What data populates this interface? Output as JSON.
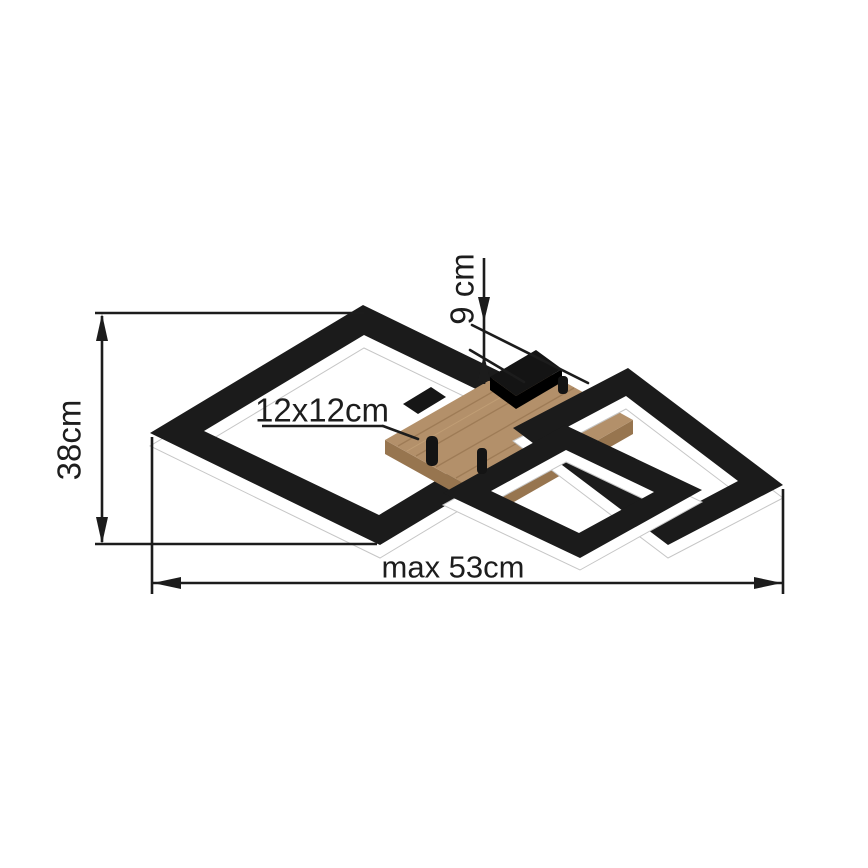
{
  "page": {
    "background": "#ffffff",
    "title": "Ceiling light dimension diagram"
  },
  "diagram": {
    "type": "product-dimension-drawing",
    "subject": "LED ceiling light with crossed square frames on a wooden canopy",
    "dimensions": {
      "height_label": "38cm",
      "width_label": "max 53cm",
      "canopy_label": "12x12cm",
      "depth_label": "9 cm"
    },
    "colors": {
      "line": "#1c1c1c",
      "frame_black": "#1b1b1b",
      "led_band_white": "#ffffff",
      "band_outline": "#c6c6c6",
      "wood_top": "#b3906a",
      "wood_side": "#97754f",
      "wood_grain": "#8d6b47",
      "background": "#ffffff"
    }
  }
}
